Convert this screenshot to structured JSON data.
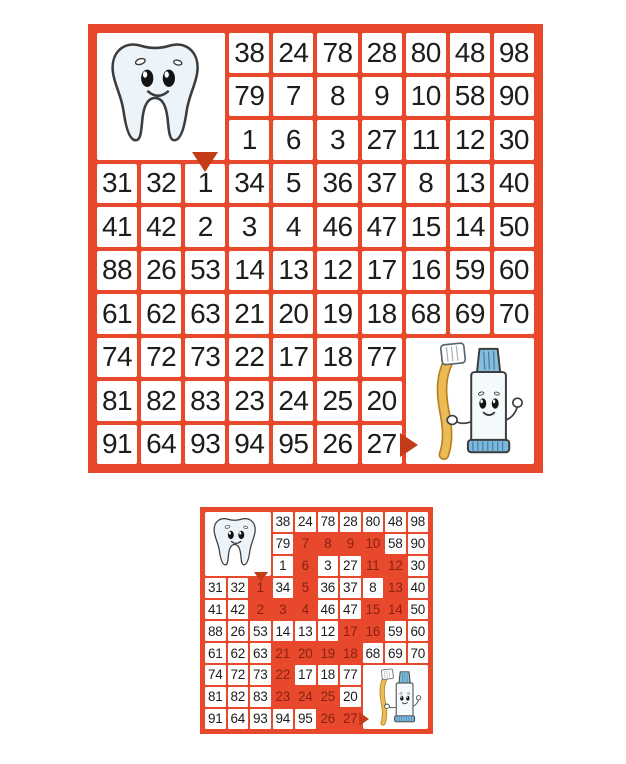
{
  "scene": {
    "kind": "math maze worksheet with answer key",
    "background": "#ffffff"
  },
  "colors": {
    "grid": "#e8492c",
    "cell": "#ffffff",
    "number": "#1d1d1b",
    "highlight_cell": "#e8492c",
    "highlight_number": "#8a2113",
    "arrow": "#c43b17"
  },
  "characters": {
    "start": "tooth",
    "goal": "toothpaste-with-toothbrush"
  },
  "maze": {
    "rows": 10,
    "cols": 10,
    "tooth_area": {
      "row": 1,
      "col": 1,
      "row_span": 3,
      "col_span": 3
    },
    "paste_area": {
      "row": 8,
      "col": 8,
      "row_span": 3,
      "col_span": 3
    },
    "grid": [
      [
        null,
        null,
        null,
        38,
        24,
        78,
        28,
        80,
        48,
        98
      ],
      [
        null,
        null,
        null,
        79,
        7,
        8,
        9,
        10,
        58,
        90
      ],
      [
        null,
        null,
        null,
        1,
        6,
        3,
        27,
        11,
        12,
        30
      ],
      [
        31,
        32,
        1,
        34,
        5,
        36,
        37,
        8,
        13,
        40
      ],
      [
        41,
        42,
        2,
        3,
        4,
        46,
        47,
        15,
        14,
        50
      ],
      [
        88,
        26,
        53,
        14,
        13,
        12,
        17,
        16,
        59,
        60
      ],
      [
        61,
        62,
        63,
        21,
        20,
        19,
        18,
        68,
        69,
        70
      ],
      [
        74,
        72,
        73,
        22,
        17,
        18,
        77,
        null,
        null,
        null
      ],
      [
        81,
        82,
        83,
        23,
        24,
        25,
        20,
        null,
        null,
        null
      ],
      [
        91,
        64,
        93,
        94,
        95,
        26,
        27,
        null,
        null,
        null
      ]
    ],
    "start_cell": {
      "row": 4,
      "col": 3,
      "value": 1
    },
    "exit_cell": {
      "row": 10,
      "col": 7,
      "value": 27
    },
    "solution_path": [
      [
        4,
        3
      ],
      [
        5,
        3
      ],
      [
        5,
        4
      ],
      [
        5,
        5
      ],
      [
        4,
        5
      ],
      [
        3,
        5
      ],
      [
        2,
        5
      ],
      [
        2,
        6
      ],
      [
        2,
        7
      ],
      [
        2,
        8
      ],
      [
        3,
        8
      ],
      [
        3,
        9
      ],
      [
        4,
        9
      ],
      [
        5,
        9
      ],
      [
        5,
        8
      ],
      [
        6,
        8
      ],
      [
        6,
        7
      ],
      [
        7,
        7
      ],
      [
        7,
        6
      ],
      [
        7,
        5
      ],
      [
        7,
        4
      ],
      [
        8,
        4
      ],
      [
        9,
        4
      ],
      [
        9,
        5
      ],
      [
        9,
        6
      ],
      [
        10,
        6
      ],
      [
        10,
        7
      ]
    ]
  },
  "panels": [
    {
      "id": "maze-big",
      "variant": "puzzle",
      "show_solution": false
    },
    {
      "id": "maze-small",
      "variant": "solution",
      "show_solution": true
    }
  ]
}
